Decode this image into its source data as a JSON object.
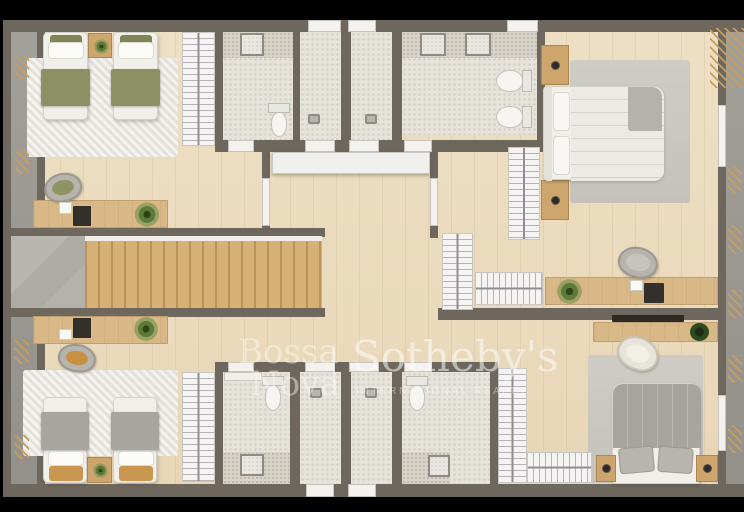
{
  "watermark": {
    "brand_top": "Bossa",
    "brand_bottom": "Nova",
    "divider": "|",
    "brokerage": "Sotheby's",
    "brokerage_subtitle": "INTERNATIONAL REALTY"
  },
  "palette": {
    "background": "#000000",
    "wall": "#6e675d",
    "wood_floor": "#ecdcbf",
    "stair_wood": "#d5b175",
    "desk_wood": "#d9b888",
    "nightstand_wood": "#cda56d",
    "bathroom_floor": "#e6e3db",
    "shower_floor": "#d8d4c9",
    "exterior_stone": "#9c9993",
    "landing_stone": "#b3b0a9",
    "rug_light": "#eae7e0",
    "rug_gray": "#cbc8c2",
    "bedding_green": "#8b9164",
    "bedding_gray": "#a7a39d",
    "bed_white": "#f1efe9",
    "plant_green": "#5c7a38",
    "watermark_white": "rgba(250,250,249,0.45)"
  },
  "plan": {
    "type": "residential-floor-plan-top-view",
    "rooms": [
      {
        "name": "bedroom-twin-top-left",
        "furniture": [
          "twin-bed",
          "twin-bed",
          "nightstand-with-plant",
          "area-rug",
          "wardrobe",
          "desk",
          "chair",
          "laptop",
          "notepad",
          "plant"
        ]
      },
      {
        "name": "bathroom-top-left",
        "furniture": [
          "shower",
          "toilet"
        ]
      },
      {
        "name": "shower-room-top-center-left",
        "furniture": [
          "floor-drain"
        ]
      },
      {
        "name": "shower-room-top-center-right",
        "furniture": [
          "floor-drain"
        ]
      },
      {
        "name": "bathroom-top-right",
        "furniture": [
          "shower",
          "shower",
          "toilet",
          "bidet"
        ]
      },
      {
        "name": "bedroom-double-top-right",
        "furniture": [
          "double-bed",
          "nightstand-with-lamp",
          "nightstand-with-lamp",
          "area-rug",
          "wardrobe"
        ]
      },
      {
        "name": "hallway-and-staircase",
        "furniture": [
          "staircase",
          "stone-landing",
          "console-cabinet"
        ]
      },
      {
        "name": "study-area-right",
        "furniture": [
          "desk",
          "chair",
          "laptop",
          "notepad",
          "plant",
          "wardrobe",
          "wardrobe"
        ]
      },
      {
        "name": "bedroom-twin-bottom-left",
        "furniture": [
          "twin-bed",
          "twin-bed",
          "nightstand-with-plant",
          "area-rug",
          "wardrobe",
          "desk",
          "chair",
          "laptop",
          "notepad",
          "plant"
        ]
      },
      {
        "name": "bathroom-bottom-left",
        "furniture": [
          "toilet",
          "shower",
          "vanity-cabinet"
        ]
      },
      {
        "name": "shower-room-bottom-center-left",
        "furniture": [
          "floor-drain"
        ]
      },
      {
        "name": "shower-room-bottom-center-right",
        "furniture": [
          "floor-drain"
        ]
      },
      {
        "name": "bathroom-bottom-right",
        "furniture": [
          "toilet",
          "shower"
        ]
      },
      {
        "name": "bedroom-double-bottom-right",
        "furniture": [
          "double-bed",
          "nightstand",
          "nightstand",
          "area-rug",
          "wardrobe",
          "wardrobe",
          "media-shelf",
          "tv",
          "chair",
          "plant"
        ]
      }
    ]
  }
}
